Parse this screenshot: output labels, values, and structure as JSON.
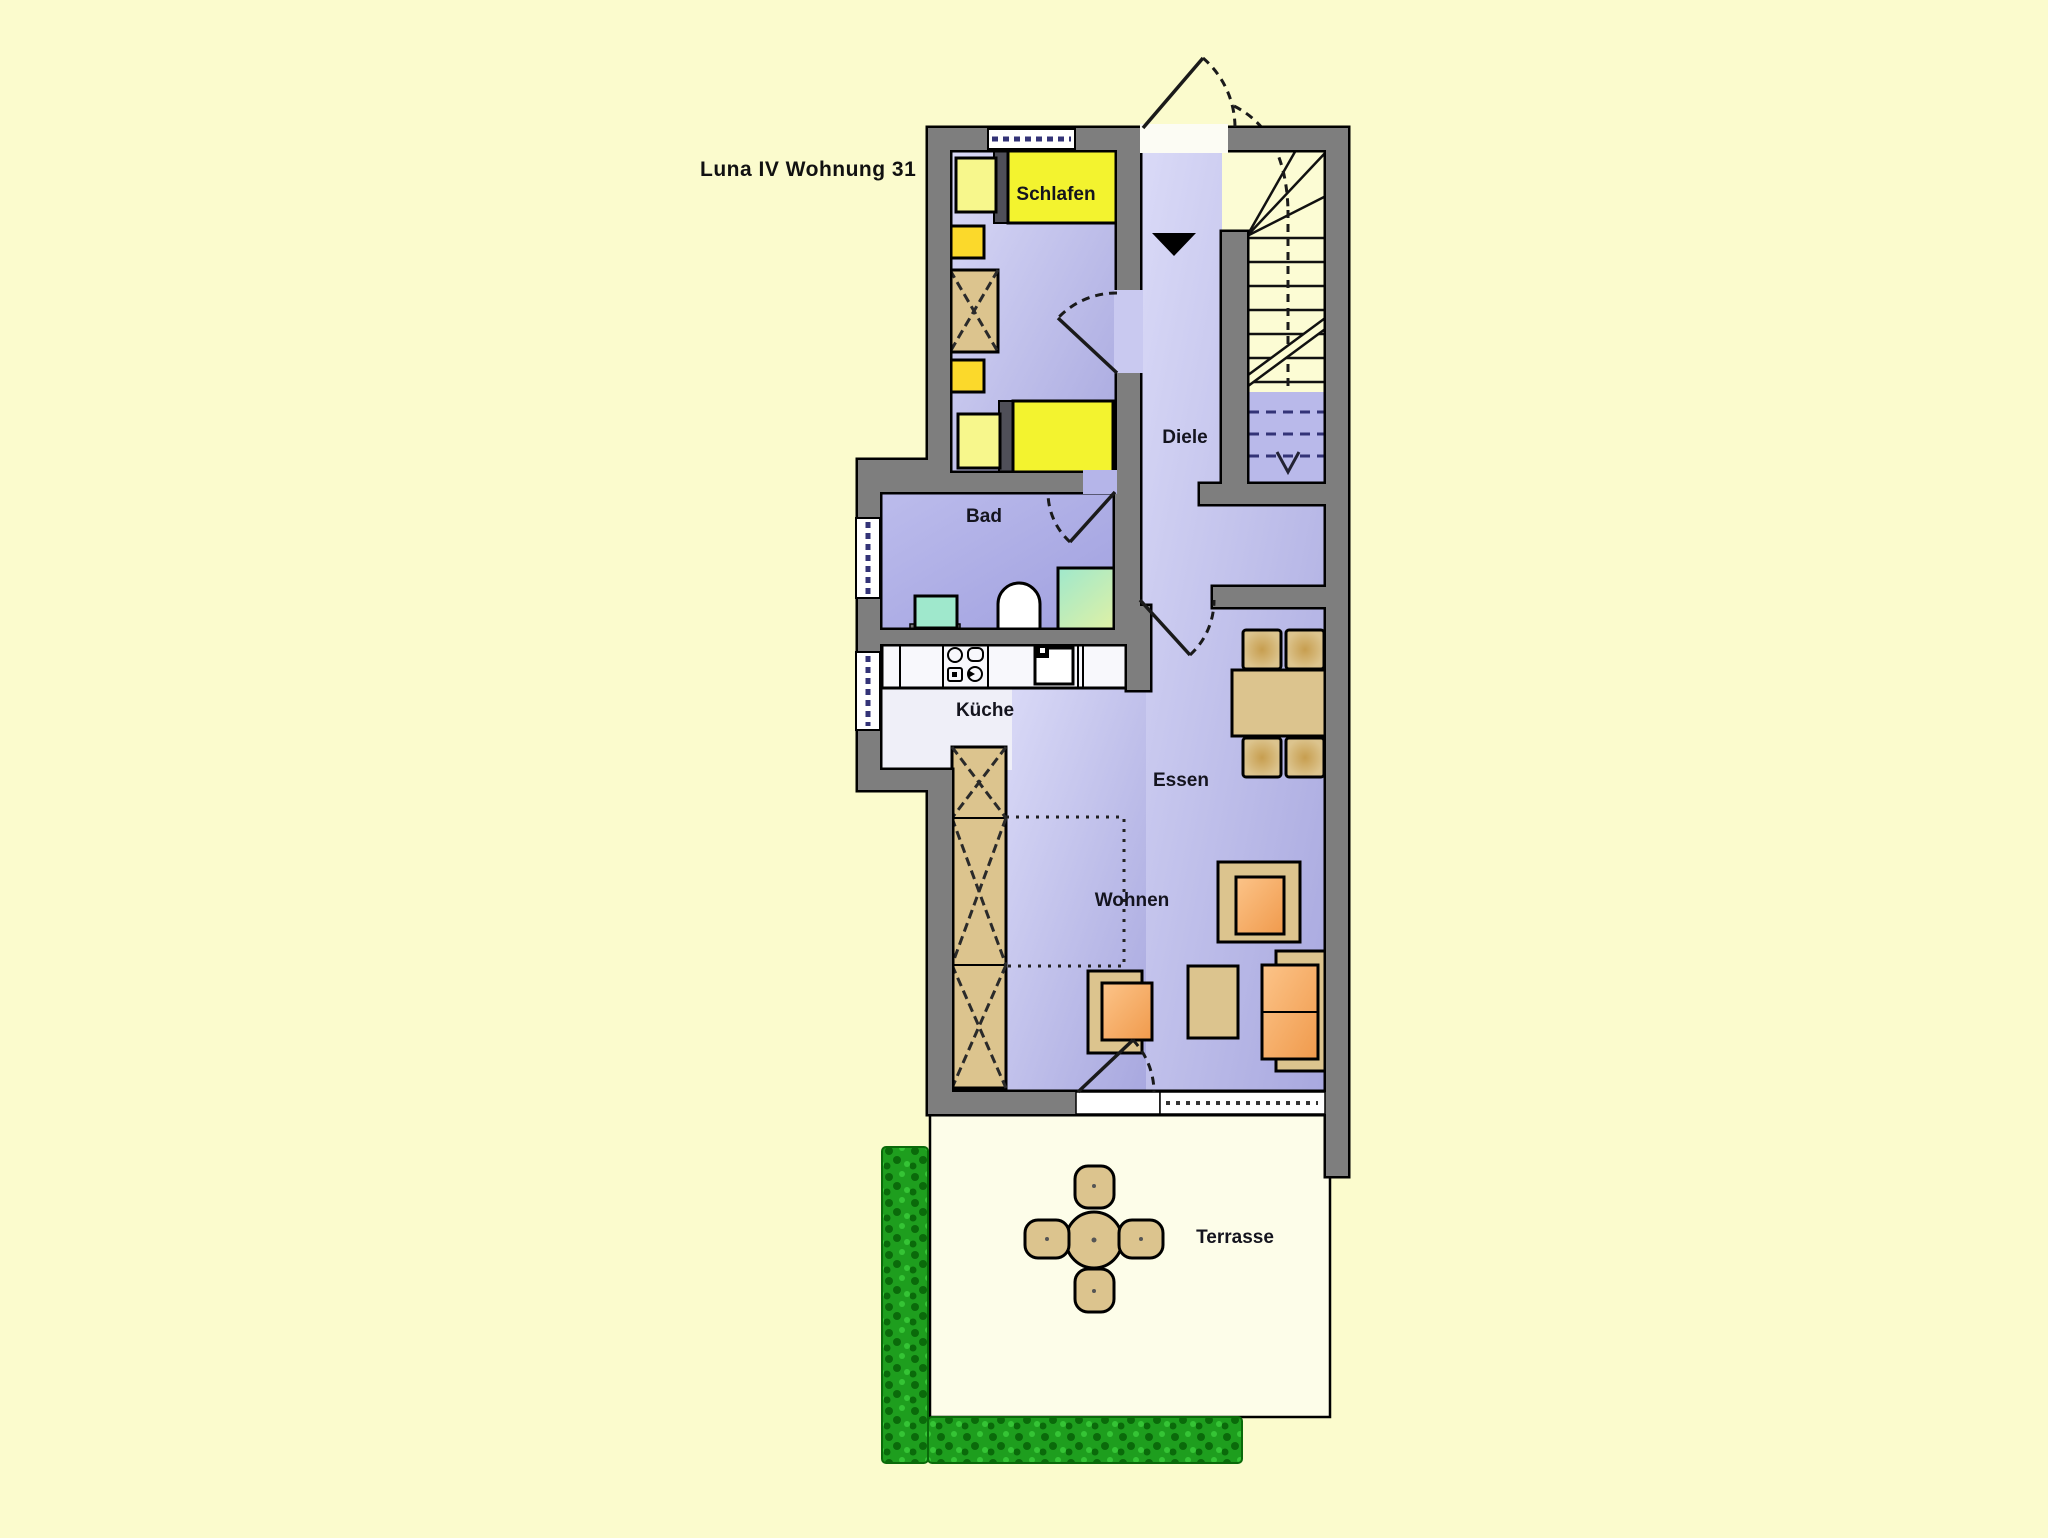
{
  "title": "Luna IV Wohnung 31",
  "rooms": {
    "schlafen": {
      "label": "Schlafen"
    },
    "diele": {
      "label": "Diele"
    },
    "bad": {
      "label": "Bad"
    },
    "kueche": {
      "label": "Küche"
    },
    "essen": {
      "label": "Essen"
    },
    "wohnen": {
      "label": "Wohnen"
    },
    "terrasse": {
      "label": "Terrasse"
    }
  },
  "colors": {
    "background": "#FBFBCD",
    "wall": "#7E7E7E",
    "room-light": "#DADAF7",
    "room-dark": "#A8A8DF",
    "bath-light": "#BCBCEC",
    "bath-dark": "#A0A0DF",
    "bed-yellow": "#F3F32F",
    "pillow-yellow": "#F7F78C",
    "nightstand-yellow": "#FBD92B",
    "wood-tan": "#DCC48E",
    "wood-dark": "#C79E4F",
    "seat-orange": "#F09A4C",
    "seat-orange-light": "#FCC489",
    "fixture-teal": "#9FE8CC",
    "shower-green": "#E8F2A0",
    "counter-white": "#F8F8FC",
    "kitchen-floor": "#EFEFF8",
    "terrace-floor": "#FDFDE9",
    "hedge-green": "#1E9E1E",
    "hedge-dark": "#0A6A0A",
    "hedge-light": "#35C435",
    "window-dash": "#333377",
    "title-color": "#111111"
  }
}
